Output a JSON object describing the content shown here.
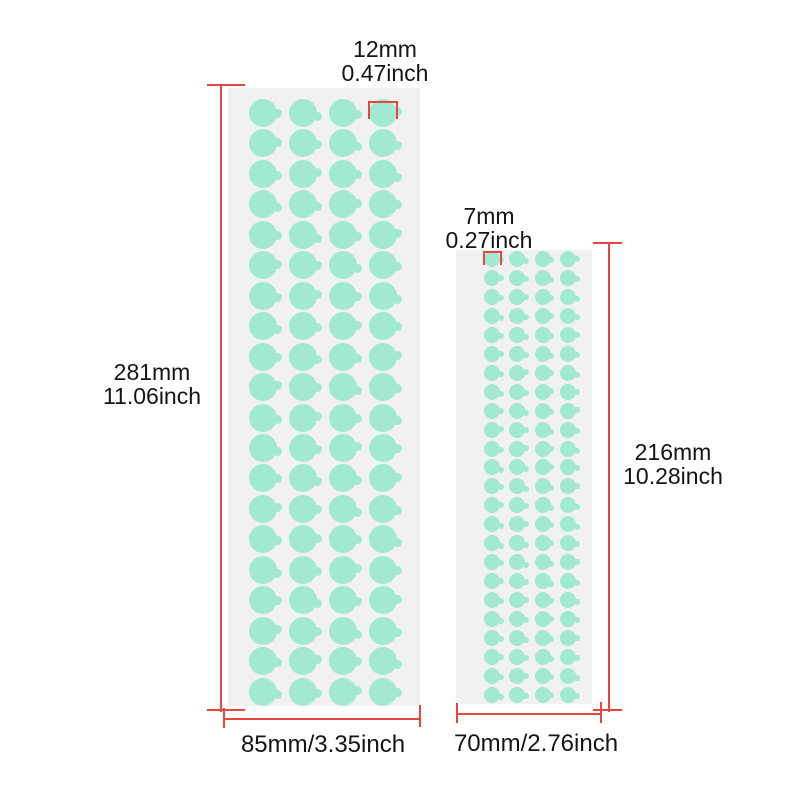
{
  "colors": {
    "dot": "#a2e9d1",
    "sheet": "#f1f1f2",
    "line": "#e9453f",
    "text": "#141414",
    "page_background": "#ffffff"
  },
  "sheets": {
    "large": {
      "description": "large sticker dot sheet",
      "rows": 20,
      "cols": 4,
      "dot_count": 80,
      "dot_size_label": {
        "mm": "12mm",
        "inch": "0.47inch"
      },
      "height_label": {
        "mm": "281mm",
        "inch": "11.06inch"
      },
      "width_label": "85mm/3.35inch",
      "layout": {
        "x": 228,
        "y": 88,
        "w": 192,
        "h": 618,
        "dot_d": 28,
        "col_start": 35,
        "col_pitch": 40,
        "row_start": 25,
        "row_pitch": 30.45,
        "tab_w": 9,
        "tab_h": 9
      }
    },
    "small": {
      "description": "small sticker dot sheet",
      "rows": 24,
      "cols": 4,
      "dot_count": 96,
      "dot_size_label": {
        "mm": "7mm",
        "inch": "0.27inch"
      },
      "height_label": {
        "mm": "216mm",
        "inch": "10.28inch"
      },
      "width_label": "70mm/2.76inch",
      "layout": {
        "x": 456,
        "y": 250,
        "w": 136,
        "h": 454,
        "dot_d": 16,
        "col_start": 36,
        "col_pitch": 25.4,
        "row_start": 9,
        "row_pitch": 18.95,
        "tab_w": 6,
        "tab_h": 6
      }
    }
  }
}
